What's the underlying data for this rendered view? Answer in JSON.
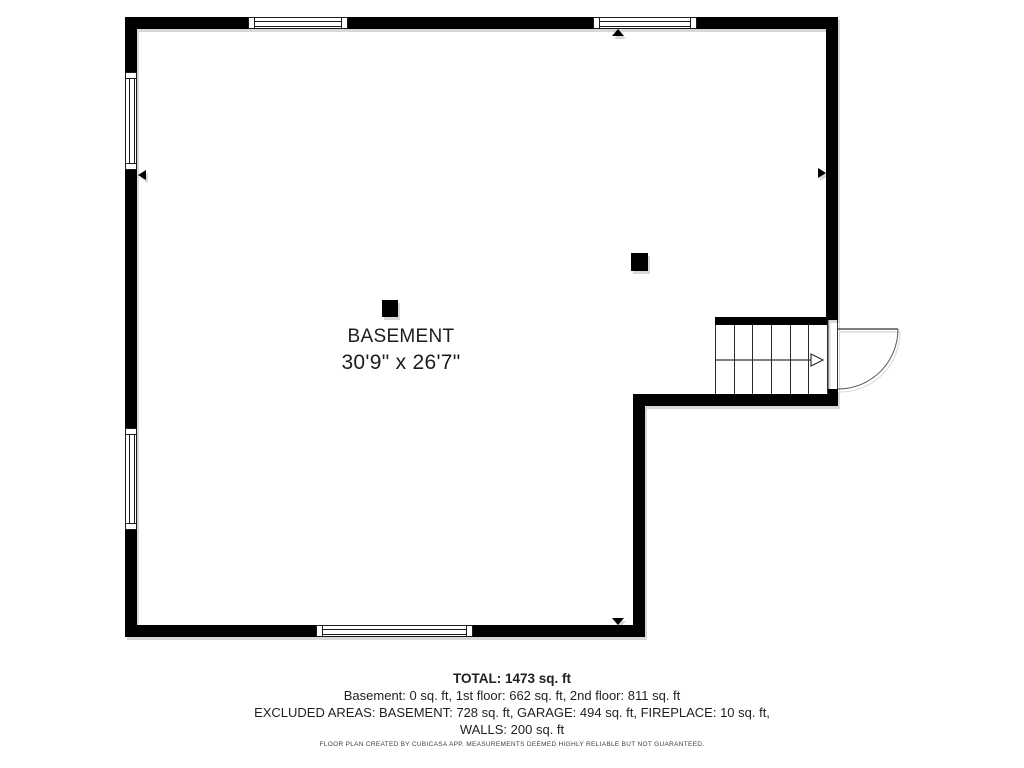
{
  "floor_plan": {
    "room_label": "BASEMENT",
    "room_dimensions": "30'9\" x 26'7\""
  },
  "summary": {
    "total": "TOTAL: 1473 sq. ft",
    "floor_breakdown": "Basement: 0 sq. ft, 1st floor: 662 sq. ft, 2nd floor: 811 sq. ft",
    "excluded_areas_line1": "EXCLUDED AREAS: BASEMENT: 728 sq. ft, GARAGE: 494 sq. ft, FIREPLACE: 10 sq. ft,",
    "excluded_areas_line2": "WALLS: 200 sq. ft"
  },
  "footer": {
    "disclaimer": "FLOOR PLAN CREATED BY CUBICASA APP. MEASUREMENTS DEEMED HIGHLY RELIABLE BUT NOT GUARANTEED."
  }
}
